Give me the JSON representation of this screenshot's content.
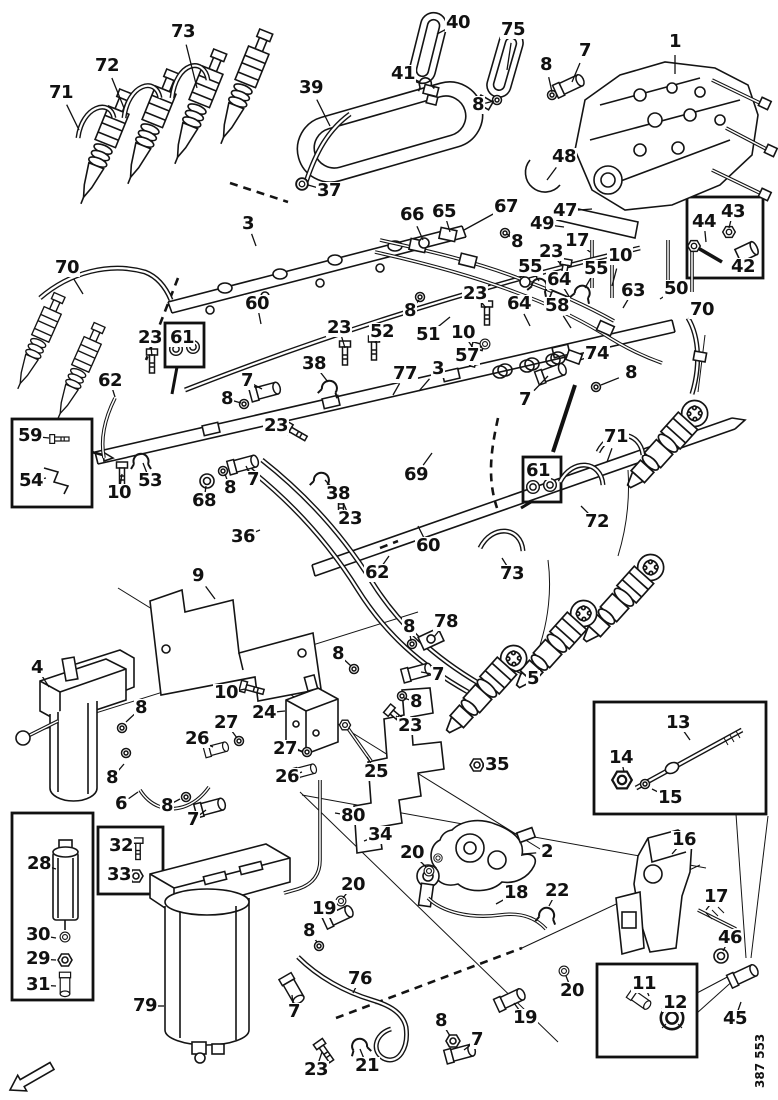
{
  "figure_number": "387 553",
  "colors": {
    "ink": "#141414",
    "paper": "#ffffff"
  },
  "callouts": [
    {
      "n": "73",
      "x": 183,
      "y": 32,
      "t": [
        197,
        88
      ]
    },
    {
      "n": "40",
      "x": 458,
      "y": 23,
      "t": [
        437,
        34
      ]
    },
    {
      "n": "75",
      "x": 513,
      "y": 30,
      "t": [
        507,
        70
      ]
    },
    {
      "n": "7",
      "x": 585,
      "y": 51,
      "t": [
        572,
        82
      ]
    },
    {
      "n": "1",
      "x": 675,
      "y": 42,
      "t": [
        675,
        74
      ]
    },
    {
      "n": "8",
      "x": 546,
      "y": 65,
      "t": [
        552,
        92
      ]
    },
    {
      "n": "72",
      "x": 107,
      "y": 66,
      "t": [
        124,
        108
      ]
    },
    {
      "n": "41",
      "x": 403,
      "y": 74,
      "t": [
        420,
        82
      ]
    },
    {
      "n": "39",
      "x": 311,
      "y": 88,
      "t": [
        330,
        126
      ]
    },
    {
      "n": "71",
      "x": 61,
      "y": 93,
      "t": [
        79,
        130
      ]
    },
    {
      "n": "8",
      "x": 478,
      "y": 105,
      "t": [
        494,
        101
      ]
    },
    {
      "n": "48",
      "x": 564,
      "y": 157,
      "t": [
        547,
        180
      ]
    },
    {
      "n": "37",
      "x": 329,
      "y": 191,
      "t": [
        308,
        185
      ]
    },
    {
      "n": "67",
      "x": 506,
      "y": 207,
      "t": [
        464,
        230
      ]
    },
    {
      "n": "47",
      "x": 565,
      "y": 211,
      "t": [
        592,
        209
      ]
    },
    {
      "n": "65",
      "x": 444,
      "y": 212,
      "t": [
        450,
        232
      ]
    },
    {
      "n": "66",
      "x": 412,
      "y": 215,
      "t": [
        423,
        240
      ]
    },
    {
      "n": "3",
      "x": 248,
      "y": 224,
      "t": [
        256,
        246
      ]
    },
    {
      "n": "49",
      "x": 542,
      "y": 224,
      "t": [
        564,
        227
      ]
    },
    {
      "n": "17",
      "x": 577,
      "y": 241,
      "t": [
        590,
        252
      ]
    },
    {
      "n": "8",
      "x": 517,
      "y": 242,
      "t": [
        507,
        234
      ]
    },
    {
      "n": "23",
      "x": 551,
      "y": 252,
      "t": [
        562,
        266
      ]
    },
    {
      "n": "10",
      "x": 620,
      "y": 256,
      "t": [
        612,
        286
      ]
    },
    {
      "n": "55",
      "x": 530,
      "y": 267,
      "t": [
        539,
        281
      ]
    },
    {
      "n": "70",
      "x": 67,
      "y": 268,
      "t": [
        83,
        294
      ]
    },
    {
      "n": "55",
      "x": 596,
      "y": 269,
      "t": [
        585,
        288
      ]
    },
    {
      "n": "64",
      "x": 559,
      "y": 280,
      "t": [
        570,
        298
      ]
    },
    {
      "n": "50",
      "x": 676,
      "y": 289,
      "t": [
        660,
        299
      ]
    },
    {
      "n": "63",
      "x": 633,
      "y": 291,
      "t": [
        623,
        308
      ]
    },
    {
      "n": "23",
      "x": 475,
      "y": 294,
      "t": [
        486,
        308
      ]
    },
    {
      "n": "64",
      "x": 519,
      "y": 304,
      "t": [
        530,
        326
      ]
    },
    {
      "n": "60",
      "x": 257,
      "y": 304,
      "t": [
        261,
        324
      ]
    },
    {
      "n": "58",
      "x": 557,
      "y": 306,
      "t": [
        571,
        328
      ]
    },
    {
      "n": "70",
      "x": 702,
      "y": 310,
      "t": [
        689,
        319
      ]
    },
    {
      "n": "8",
      "x": 410,
      "y": 311,
      "t": [
        419,
        300
      ]
    },
    {
      "n": "23",
      "x": 339,
      "y": 328,
      "t": [
        345,
        348
      ]
    },
    {
      "n": "52",
      "x": 382,
      "y": 332,
      "t": [
        375,
        343
      ]
    },
    {
      "n": "10",
      "x": 463,
      "y": 333,
      "t": [
        473,
        348
      ]
    },
    {
      "n": "51",
      "x": 428,
      "y": 335,
      "t": [
        450,
        317
      ]
    },
    {
      "n": "23",
      "x": 150,
      "y": 338,
      "t": [
        152,
        356
      ]
    },
    {
      "n": "61",
      "x": 182,
      "y": 338
    },
    {
      "n": "74",
      "x": 597,
      "y": 354,
      "t": [
        580,
        360
      ]
    },
    {
      "n": "57",
      "x": 467,
      "y": 356,
      "t": [
        482,
        346
      ]
    },
    {
      "n": "38",
      "x": 314,
      "y": 364,
      "t": [
        328,
        382
      ]
    },
    {
      "n": "3",
      "x": 438,
      "y": 369,
      "t": [
        419,
        391
      ]
    },
    {
      "n": "8",
      "x": 631,
      "y": 373,
      "t": [
        601,
        385
      ]
    },
    {
      "n": "77",
      "x": 405,
      "y": 374,
      "t": [
        393,
        395
      ]
    },
    {
      "n": "62",
      "x": 110,
      "y": 381,
      "t": [
        115,
        397
      ]
    },
    {
      "n": "7",
      "x": 247,
      "y": 381,
      "t": [
        262,
        389
      ]
    },
    {
      "n": "8",
      "x": 227,
      "y": 399,
      "t": [
        241,
        403
      ]
    },
    {
      "n": "7",
      "x": 525,
      "y": 400,
      "t": [
        548,
        376
      ]
    },
    {
      "n": "44",
      "x": 704,
      "y": 222,
      "t": [
        706,
        242
      ]
    },
    {
      "n": "43",
      "x": 733,
      "y": 212,
      "t": [
        729,
        228
      ]
    },
    {
      "n": "42",
      "x": 743,
      "y": 267,
      "t": [
        745,
        258
      ]
    },
    {
      "n": "23",
      "x": 276,
      "y": 426,
      "t": [
        289,
        430
      ]
    },
    {
      "n": "59",
      "x": 30,
      "y": 436,
      "t": [
        49,
        438
      ]
    },
    {
      "n": "71",
      "x": 616,
      "y": 437,
      "t": [
        607,
        462
      ]
    },
    {
      "n": "53",
      "x": 150,
      "y": 481,
      "t": [
        143,
        463
      ]
    },
    {
      "n": "54",
      "x": 31,
      "y": 481,
      "t": [
        46,
        478
      ]
    },
    {
      "n": "7",
      "x": 253,
      "y": 480,
      "t": [
        246,
        466
      ]
    },
    {
      "n": "69",
      "x": 416,
      "y": 475,
      "t": [
        432,
        453
      ]
    },
    {
      "n": "61",
      "x": 538,
      "y": 471
    },
    {
      "n": "8",
      "x": 230,
      "y": 488,
      "t": [
        225,
        474
      ]
    },
    {
      "n": "38",
      "x": 338,
      "y": 494,
      "t": [
        325,
        480
      ]
    },
    {
      "n": "10",
      "x": 119,
      "y": 493,
      "t": [
        122,
        474
      ]
    },
    {
      "n": "68",
      "x": 204,
      "y": 501,
      "t": [
        206,
        486
      ]
    },
    {
      "n": "23",
      "x": 350,
      "y": 519,
      "t": [
        343,
        502
      ]
    },
    {
      "n": "72",
      "x": 597,
      "y": 522,
      "t": [
        581,
        506
      ]
    },
    {
      "n": "36",
      "x": 243,
      "y": 537,
      "t": [
        260,
        530
      ]
    },
    {
      "n": "60",
      "x": 428,
      "y": 546,
      "t": [
        418,
        526
      ]
    },
    {
      "n": "62",
      "x": 377,
      "y": 573,
      "t": [
        389,
        556
      ]
    },
    {
      "n": "73",
      "x": 512,
      "y": 574,
      "t": [
        502,
        558
      ]
    },
    {
      "n": "9",
      "x": 198,
      "y": 576,
      "t": [
        215,
        599
      ]
    },
    {
      "n": "78",
      "x": 446,
      "y": 622,
      "t": [
        434,
        637
      ]
    },
    {
      "n": "8",
      "x": 409,
      "y": 627,
      "t": [
        411,
        641
      ]
    },
    {
      "n": "8",
      "x": 338,
      "y": 654,
      "t": [
        351,
        666
      ]
    },
    {
      "n": "4",
      "x": 37,
      "y": 668,
      "t": [
        49,
        687
      ]
    },
    {
      "n": "7",
      "x": 438,
      "y": 675,
      "t": [
        421,
        672
      ]
    },
    {
      "n": "5",
      "x": 533,
      "y": 679,
      "t": [
        509,
        668
      ]
    },
    {
      "n": "10",
      "x": 226,
      "y": 693,
      "t": [
        245,
        689
      ]
    },
    {
      "n": "8",
      "x": 416,
      "y": 702,
      "t": [
        404,
        698
      ]
    },
    {
      "n": "8",
      "x": 141,
      "y": 708,
      "t": [
        126,
        722
      ]
    },
    {
      "n": "24",
      "x": 264,
      "y": 713,
      "t": [
        285,
        711
      ]
    },
    {
      "n": "27",
      "x": 226,
      "y": 723,
      "t": [
        237,
        738
      ]
    },
    {
      "n": "23",
      "x": 410,
      "y": 726,
      "t": [
        396,
        716
      ]
    },
    {
      "n": "26",
      "x": 197,
      "y": 739,
      "t": [
        213,
        747
      ]
    },
    {
      "n": "27",
      "x": 285,
      "y": 749,
      "t": [
        302,
        751
      ]
    },
    {
      "n": "13",
      "x": 678,
      "y": 723,
      "t": [
        690,
        740
      ]
    },
    {
      "n": "14",
      "x": 621,
      "y": 758,
      "t": [
        624,
        772
      ]
    },
    {
      "n": "15",
      "x": 670,
      "y": 798,
      "t": [
        652,
        789
      ]
    },
    {
      "n": "26",
      "x": 287,
      "y": 777,
      "t": [
        302,
        772
      ]
    },
    {
      "n": "25",
      "x": 376,
      "y": 772,
      "t": [
        367,
        757
      ]
    },
    {
      "n": "8",
      "x": 112,
      "y": 778,
      "t": [
        124,
        764
      ]
    },
    {
      "n": "35",
      "x": 497,
      "y": 765,
      "t": [
        482,
        765
      ]
    },
    {
      "n": "6",
      "x": 121,
      "y": 804,
      "t": [
        138,
        792
      ]
    },
    {
      "n": "8",
      "x": 167,
      "y": 806,
      "t": [
        180,
        799
      ]
    },
    {
      "n": "7",
      "x": 193,
      "y": 820,
      "t": [
        206,
        810
      ]
    },
    {
      "n": "80",
      "x": 353,
      "y": 816,
      "t": [
        335,
        813
      ]
    },
    {
      "n": "34",
      "x": 380,
      "y": 835,
      "t": [
        364,
        841
      ]
    },
    {
      "n": "16",
      "x": 684,
      "y": 840,
      "t": [
        672,
        854
      ]
    },
    {
      "n": "20",
      "x": 412,
      "y": 853,
      "t": [
        426,
        867
      ]
    },
    {
      "n": "2",
      "x": 547,
      "y": 852,
      "t": [
        523,
        854
      ]
    },
    {
      "n": "28",
      "x": 39,
      "y": 864,
      "t": [
        56,
        869
      ]
    },
    {
      "n": "32",
      "x": 121,
      "y": 846,
      "t": [
        134,
        847
      ]
    },
    {
      "n": "33",
      "x": 119,
      "y": 875,
      "t": [
        132,
        876
      ]
    },
    {
      "n": "22",
      "x": 557,
      "y": 891,
      "t": [
        549,
        906
      ]
    },
    {
      "n": "18",
      "x": 516,
      "y": 893,
      "t": [
        496,
        904
      ]
    },
    {
      "n": "17",
      "x": 716,
      "y": 897,
      "t": [
        706,
        910
      ]
    },
    {
      "n": "20",
      "x": 353,
      "y": 885,
      "t": [
        343,
        898
      ]
    },
    {
      "n": "19",
      "x": 324,
      "y": 909,
      "t": [
        334,
        913
      ]
    },
    {
      "n": "8",
      "x": 309,
      "y": 931,
      "t": [
        317,
        942
      ]
    },
    {
      "n": "30",
      "x": 38,
      "y": 935,
      "t": [
        56,
        938
      ]
    },
    {
      "n": "46",
      "x": 730,
      "y": 938,
      "t": [
        723,
        951
      ]
    },
    {
      "n": "29",
      "x": 38,
      "y": 959,
      "t": [
        56,
        960
      ]
    },
    {
      "n": "76",
      "x": 360,
      "y": 979,
      "t": [
        353,
        993
      ]
    },
    {
      "n": "31",
      "x": 38,
      "y": 985,
      "t": [
        56,
        986
      ]
    },
    {
      "n": "11",
      "x": 644,
      "y": 984,
      "t": [
        649,
        996
      ]
    },
    {
      "n": "20",
      "x": 572,
      "y": 991,
      "t": [
        566,
        976
      ]
    },
    {
      "n": "12",
      "x": 675,
      "y": 1003,
      "t": [
        677,
        1010
      ]
    },
    {
      "n": "79",
      "x": 145,
      "y": 1006,
      "t": [
        164,
        1006
      ]
    },
    {
      "n": "7",
      "x": 294,
      "y": 1012,
      "t": [
        292,
        995
      ]
    },
    {
      "n": "19",
      "x": 525,
      "y": 1018,
      "t": [
        514,
        1003
      ]
    },
    {
      "n": "45",
      "x": 735,
      "y": 1019,
      "t": [
        741,
        1002
      ]
    },
    {
      "n": "8",
      "x": 441,
      "y": 1021,
      "t": [
        450,
        1036
      ]
    },
    {
      "n": "7",
      "x": 477,
      "y": 1040,
      "t": [
        464,
        1050
      ]
    },
    {
      "n": "21",
      "x": 367,
      "y": 1066,
      "t": [
        360,
        1049
      ]
    },
    {
      "n": "23",
      "x": 316,
      "y": 1070,
      "t": [
        322,
        1052
      ]
    }
  ],
  "inset_boxes": [
    {
      "label": "59-54",
      "x": 12,
      "y": 419,
      "w": 80,
      "h": 88
    },
    {
      "label": "61-left",
      "x": 165,
      "y": 323,
      "w": 39,
      "h": 44
    },
    {
      "label": "44-43-42",
      "x": 687,
      "y": 197,
      "w": 76,
      "h": 81
    },
    {
      "label": "61-right",
      "x": 523,
      "y": 457,
      "w": 38,
      "h": 45
    },
    {
      "label": "13-14-15",
      "x": 594,
      "y": 702,
      "w": 172,
      "h": 112
    },
    {
      "label": "28-29-30-31",
      "x": 12,
      "y": 813,
      "w": 81,
      "h": 187
    },
    {
      "label": "32-33",
      "x": 98,
      "y": 827,
      "w": 65,
      "h": 67
    },
    {
      "label": "11-12",
      "x": 597,
      "y": 964,
      "w": 100,
      "h": 93
    }
  ]
}
